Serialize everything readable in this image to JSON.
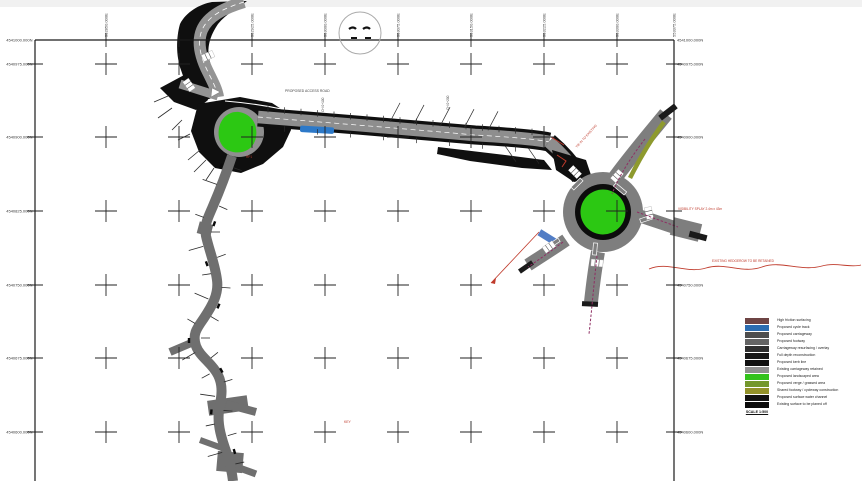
{
  "grid": {
    "top_labels": [
      "552850.000E",
      "552925.000E",
      "553000.000E",
      "553075.000E",
      "553150.000E",
      "553225.000E",
      "553300.000E",
      "553375.000E"
    ],
    "left_labels": [
      "4541000.000N",
      "4540975.000N",
      "4540900.000N",
      "4540825.000N",
      "4540750.000N",
      "4540675.000N",
      "4540600.000N"
    ],
    "right_labels": [
      "4541000.000N",
      "4540975.000N",
      "4540900.000N",
      "4540750.000N",
      "4540675.000N",
      "4540600.000N"
    ]
  },
  "annotations": {
    "road_label": "PROPOSED ACCESS ROAD",
    "chainage_label_1": "CH 0+100",
    "chainage_label_2": "CH 0+200",
    "bend_note": "TIE IN TO EXISTING",
    "visibility_note": "VISIBILITY SPLAY 2.4m x 43m",
    "hedgerow_note": "EXISTING HEDGEROW TO BE RETAINED",
    "junction_note": "RP1",
    "key_note": "KEY"
  },
  "colors": {
    "carriageway_gray": "#8e8e8e",
    "surfacing_black": "#0f0f0f",
    "island_green": "#2cc813",
    "layby_blue": "#2d79c8",
    "verge_olive": "#8e9a2e",
    "annotation_red": "#bf3a2b",
    "sweptpath_magenta": "#8f2f63"
  },
  "legend": {
    "items": [
      {
        "color": "#6e4444",
        "label": "High friction surfacing"
      },
      {
        "color": "#2b6cb0",
        "label": "Proposed cycle track"
      },
      {
        "color": "#4e4e4e",
        "label": "Proposed carriageway"
      },
      {
        "color": "#646464",
        "label": "Proposed footway"
      },
      {
        "color": "#2f2f2f",
        "label": "Carriageway resurfacing / overlay"
      },
      {
        "color": "#181818",
        "label": "Full depth reconstruction"
      },
      {
        "color": "#101010",
        "label": "Proposed kerb line"
      },
      {
        "color": "#909090",
        "label": "Existing carriageway retained"
      },
      {
        "color": "#33c21c",
        "label": "Proposed landscaped area"
      },
      {
        "color": "#74972c",
        "label": "Proposed verge / grassed area"
      },
      {
        "color": "#93922a",
        "label": "Shared footway / cycleway construction"
      },
      {
        "color": "#121212",
        "label": "Proposed surface water channel"
      },
      {
        "color": "#0b0b0b",
        "label": "Existing surface to be planed off"
      }
    ],
    "scale_label": "SCALE 1:500"
  }
}
